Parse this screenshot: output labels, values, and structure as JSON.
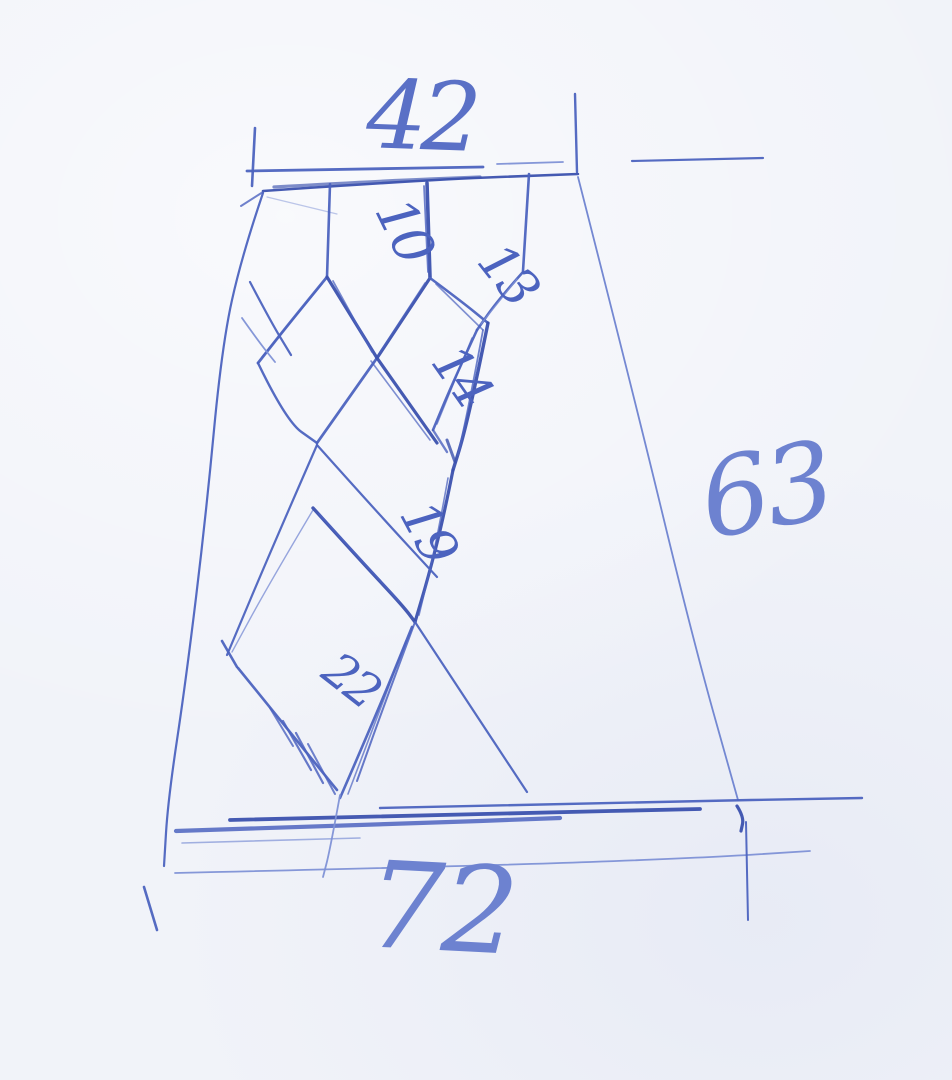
{
  "document": {
    "type": "hand-drawn sketch",
    "description": "Blue ballpoint pen sketch on paper: a trapezoidal panel filled with a diagonal diamond-lattice band, annotated with handwritten measurements"
  },
  "dimensions": {
    "top_width": {
      "value": "42",
      "position": "top edge"
    },
    "right_height": {
      "value": "63",
      "position": "right side"
    },
    "bottom_width": {
      "value": "72",
      "position": "bottom edge"
    }
  },
  "segment_labels": [
    {
      "value": "10",
      "area": "top band left of center"
    },
    {
      "value": "13",
      "area": "upper right panel"
    },
    {
      "value": "14",
      "area": "upper middle diamond"
    },
    {
      "value": "19",
      "area": "middle diamond"
    },
    {
      "value": "22",
      "area": "lower left diamond"
    }
  ],
  "colors": {
    "ink": "#4c63bf",
    "ink_dark": "#3b51ae",
    "ink_light": "#7e91d6",
    "ink_medium": "#6d82d0",
    "paper": "#f1f3f9"
  }
}
